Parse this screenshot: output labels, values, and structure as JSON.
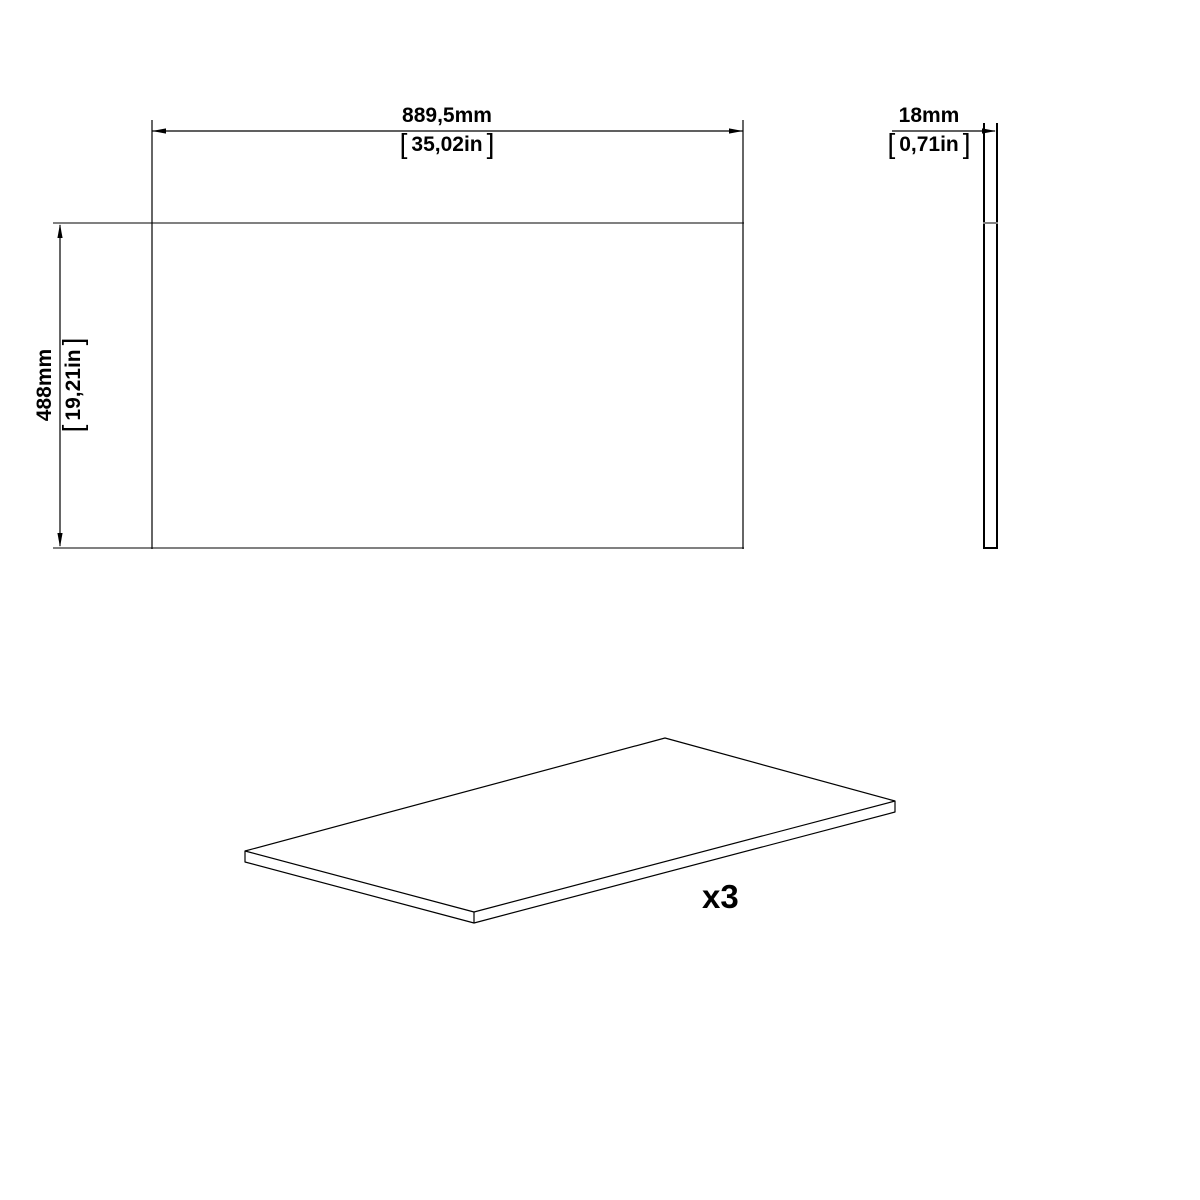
{
  "page": {
    "background": "#ffffff"
  },
  "drawing": {
    "colors": {
      "dimension_line": "#000000",
      "part_edge_gray": "#808080",
      "text": "#000000"
    },
    "brackets": {
      "open": "[",
      "close": "]"
    },
    "dimensions": {
      "width": {
        "metric": "889,5mm",
        "imperial": "35,02in"
      },
      "height": {
        "metric": "488mm",
        "imperial": "19,21in"
      },
      "thickness": {
        "metric": "18mm",
        "imperial": "0,71in"
      }
    },
    "quantity_label": "x3"
  }
}
